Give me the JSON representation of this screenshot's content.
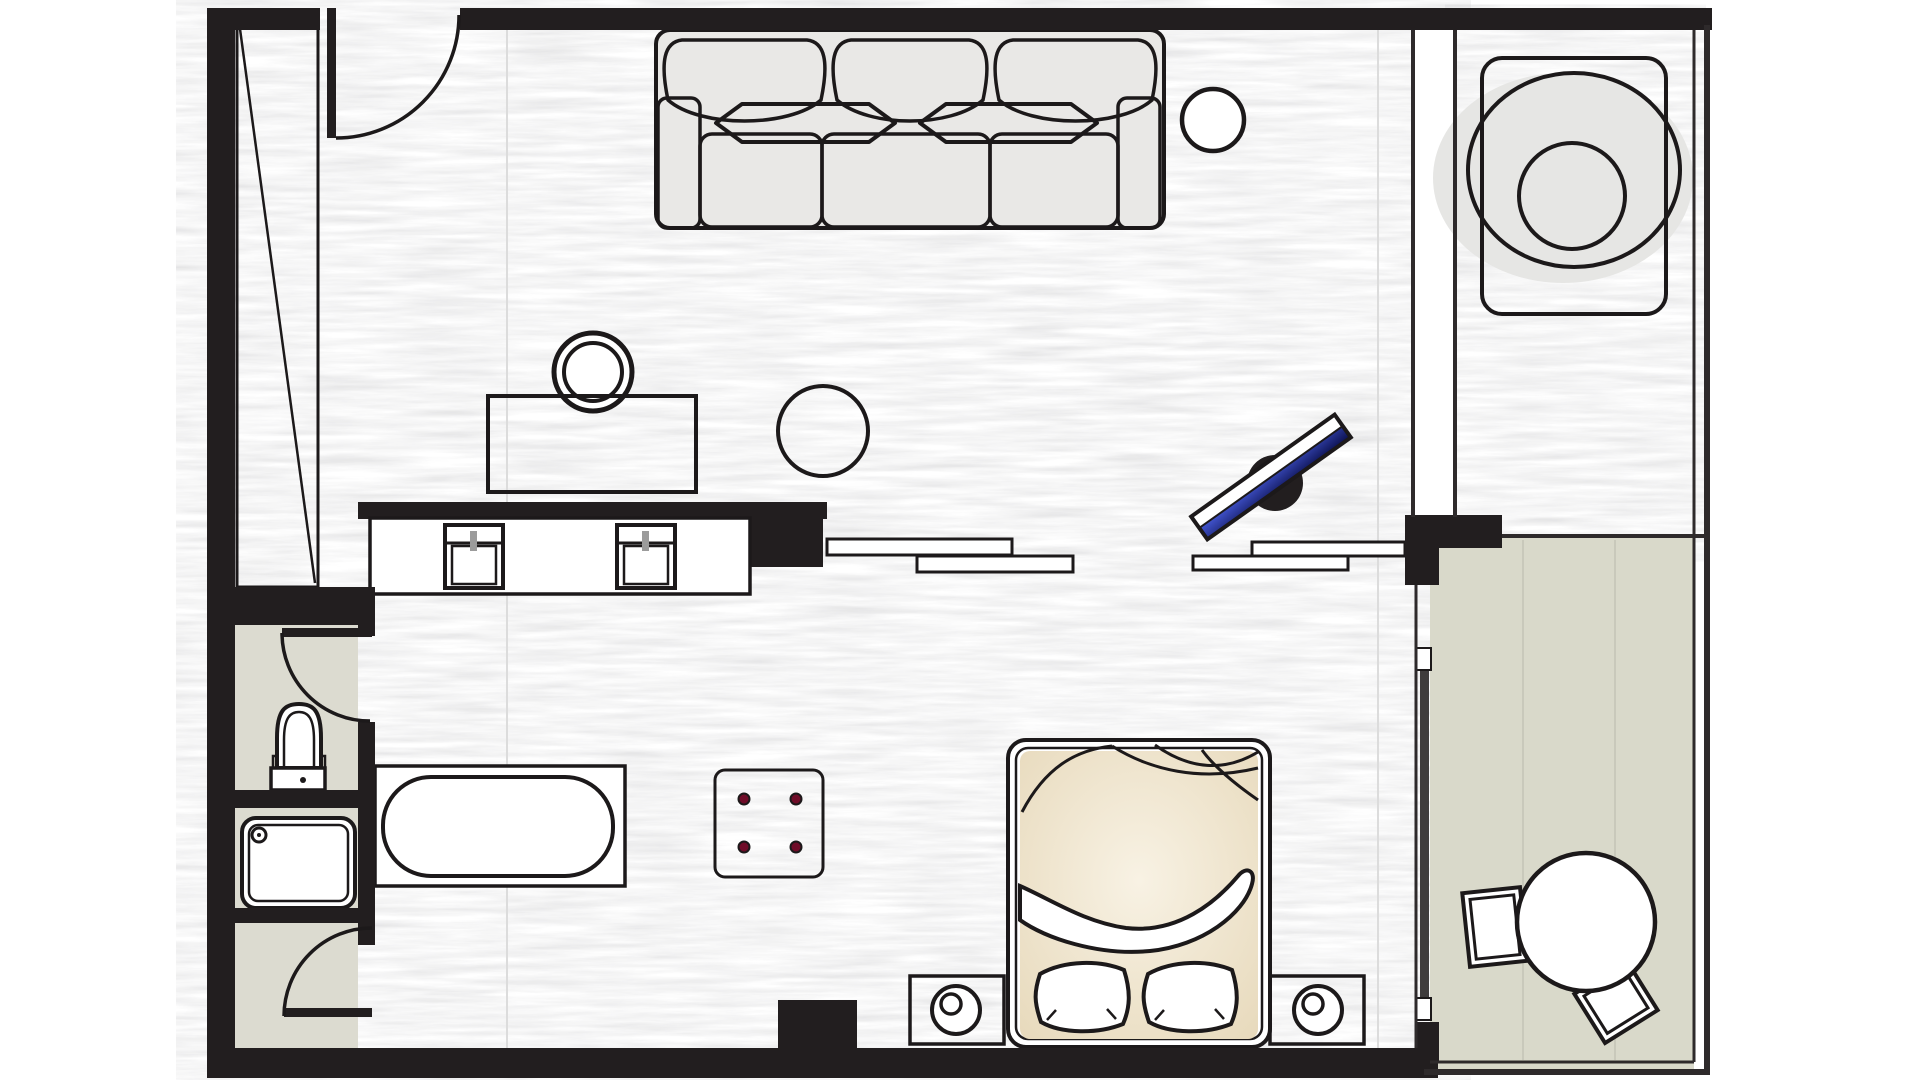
{
  "page": {
    "kind": "hotel-room-floor-plan",
    "background": "#ffffff"
  },
  "colors": {
    "wall": "#221e1f",
    "line": "#1c191a",
    "line2": "#2e2a2b",
    "white": "#ffffff",
    "wood-seam": "#dcdcdc",
    "bath-floor": "#dcdbd0",
    "balcony-floor": "#d9d9ca",
    "balcony-seam": "#c9c9bb",
    "shadow": "#e6e6e4",
    "sofa-base": "#e9e8e6",
    "sofa-hi": "#f6f6f4",
    "sofa-lo": "#d9d8d6",
    "brown-hi": "#c99c6d",
    "brown-lo": "#8e5e34",
    "red-hi": "#dd2f5c",
    "red-lo": "#a50f35",
    "red-button": "#6f0c28",
    "tv-blue-hi": "#4356d2",
    "tv-blue-lo": "#0a0f4c",
    "duvet-hi": "#f8f2e4",
    "duvet-lo": "#e7d9bb",
    "faucet": "#9b9b9b",
    "slide": "#3f3c3d"
  },
  "rooms": [
    {
      "name": "living-bedroom",
      "floor": "wood"
    },
    {
      "name": "wc-compartment",
      "floor": "tile"
    },
    {
      "name": "shower-compartment",
      "floor": "tile"
    },
    {
      "name": "bathroom-lobby",
      "floor": "tile"
    },
    {
      "name": "dressing-alcove",
      "floor": "wood"
    },
    {
      "name": "balcony",
      "floor": "concrete"
    }
  ],
  "furniture": {
    "entry_door": {
      "label": "entry door with swing arc"
    },
    "wardrobe": {
      "label": "wardrobe closet"
    },
    "sofa": {
      "label": "three-seat sofa"
    },
    "side_table": {
      "label": "round side table"
    },
    "lounge_chair": {
      "label": "round lounge chair"
    },
    "desk": {
      "label": "writing desk"
    },
    "desk_chair": {
      "label": "round desk chair"
    },
    "stool": {
      "label": "round wooden stool"
    },
    "vanity": {
      "label": "vanity counter with two sinks"
    },
    "consoles": {
      "label": "low console shelves"
    },
    "tv": {
      "label": "flat-screen tv on swivel stand"
    },
    "toilet": {
      "label": "toilet"
    },
    "shower": {
      "label": "shower tray"
    },
    "bathtub": {
      "label": "bathtub on platform"
    },
    "ottoman": {
      "label": "red tufted ottoman"
    },
    "bed": {
      "label": "double bed with duvet and pillows"
    },
    "nightstand_l": {
      "label": "left nightstand with lamp"
    },
    "nightstand_r": {
      "label": "right nightstand with lamp"
    },
    "wc_door": {
      "label": "wc door with swing arc"
    },
    "bath_door": {
      "label": "bathroom door with swing arc"
    },
    "sliding_door": {
      "label": "sliding glass balcony door"
    },
    "balcony_table": {
      "label": "round balcony table"
    },
    "balcony_chair_1": {
      "label": "balcony chair"
    },
    "balcony_chair_2": {
      "label": "balcony chair"
    }
  }
}
